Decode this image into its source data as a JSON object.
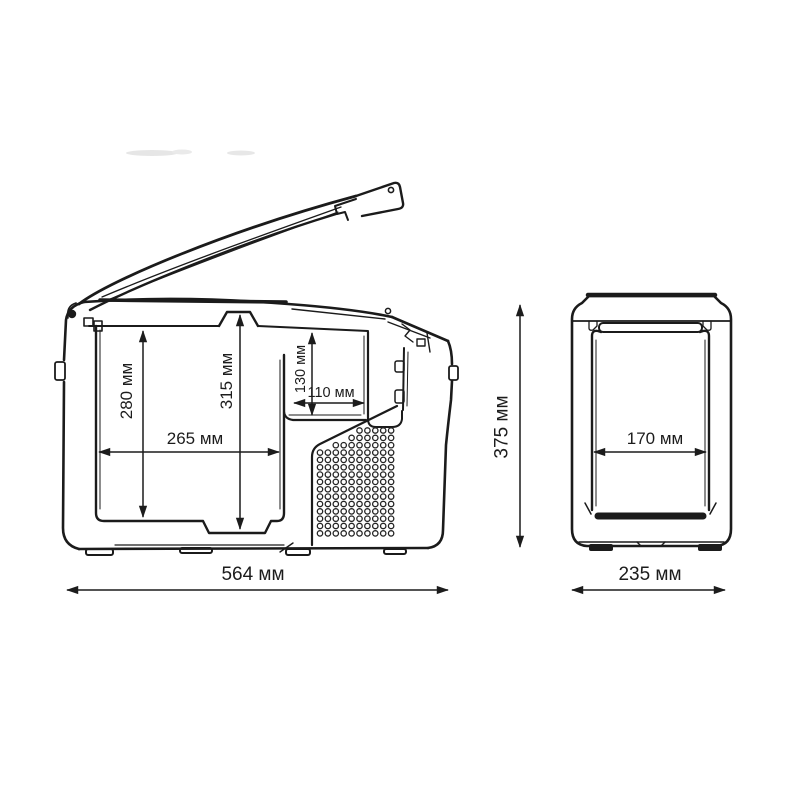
{
  "figure": {
    "kind": "technical dimensional drawing",
    "subject": "portable cooler box with open lid, side section view and front view",
    "unit": "мм",
    "background_color": "#ffffff",
    "line_color": "#1b1b1b"
  },
  "side_view": {
    "name": "side section view with lid open",
    "dimensions": {
      "inner_depth_main": "280 мм",
      "inner_depth_total": "315 мм",
      "step_depth": "130 мм",
      "step_width": "110 мм",
      "inner_length": "265 мм",
      "overall_length": "564 мм"
    },
    "vent_grille": {
      "cols": 10,
      "rows": 15
    }
  },
  "front_view": {
    "name": "front view",
    "dimensions": {
      "overall_height": "375 мм",
      "inner_width": "170 мм",
      "overall_width": "235 мм"
    }
  }
}
